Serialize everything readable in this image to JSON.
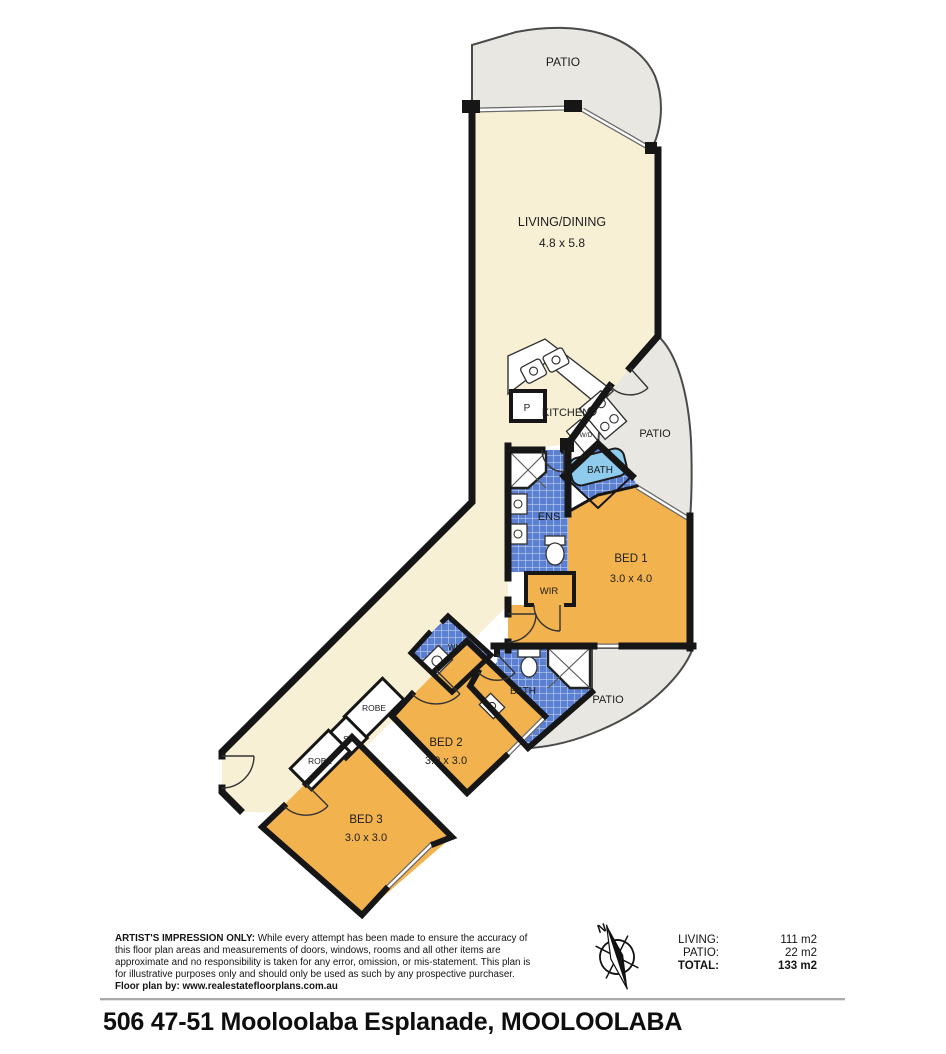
{
  "rooms": {
    "patio_top": {
      "label": "PATIO"
    },
    "living": {
      "label": "LIVING/DINING",
      "dims": "4.8 x 5.8"
    },
    "kitchen": {
      "label": "KITCHEN"
    },
    "pantry": {
      "label": "P"
    },
    "fridge": {
      "label": "F"
    },
    "wd": {
      "label": "W/D"
    },
    "patio_right": {
      "label": "PATIO"
    },
    "bath1": {
      "label": "BATH"
    },
    "ens": {
      "label": "ENS"
    },
    "bed1": {
      "label": "BED 1",
      "dims": "3.0 x 4.0"
    },
    "wir": {
      "label": "WIR"
    },
    "wm": {
      "label": "WM"
    },
    "bath2": {
      "label": "BATH"
    },
    "patio_mid": {
      "label": "PATIO"
    },
    "bed2": {
      "label": "BED 2",
      "dims": "3.0 x 3.0"
    },
    "robe1": {
      "label": "ROBE"
    },
    "store": {
      "label": "S"
    },
    "robe2": {
      "label": "ROBE"
    },
    "bed3": {
      "label": "BED 3",
      "dims": "3.0 x 3.0"
    }
  },
  "legend": {
    "rows": [
      {
        "label": "LIVING:",
        "value": "111 m2"
      },
      {
        "label": "PATIO:",
        "value": "22 m2"
      },
      {
        "label": "TOTAL:",
        "value": "133 m2"
      }
    ]
  },
  "compass": {
    "north": "N"
  },
  "disclaimer": {
    "heading": "ARTIST'S IMPRESSION ONLY:",
    "body": " While every attempt has been made to ensure the accuracy of this floor plan areas and measurements of doors, windows, rooms and all other items are approximate and no responsibility is taken for any error, omission, or mis-statement. This plan is for illustrative purposes only and should only be used as such by any prospective purchaser.",
    "credit": "Floor plan by: www.realestatefloorplans.com.au"
  },
  "footer": {
    "address": "506 47-51 Mooloolaba Esplanade, MOOLOOLABA"
  },
  "colors": {
    "cream": "#f7f0d5",
    "orange": "#f2b24e",
    "tile_blue": "#5b80d2",
    "tub_blue": "#8ecbec",
    "patio_grey": "#e9e7e2",
    "wall": "#161616"
  }
}
